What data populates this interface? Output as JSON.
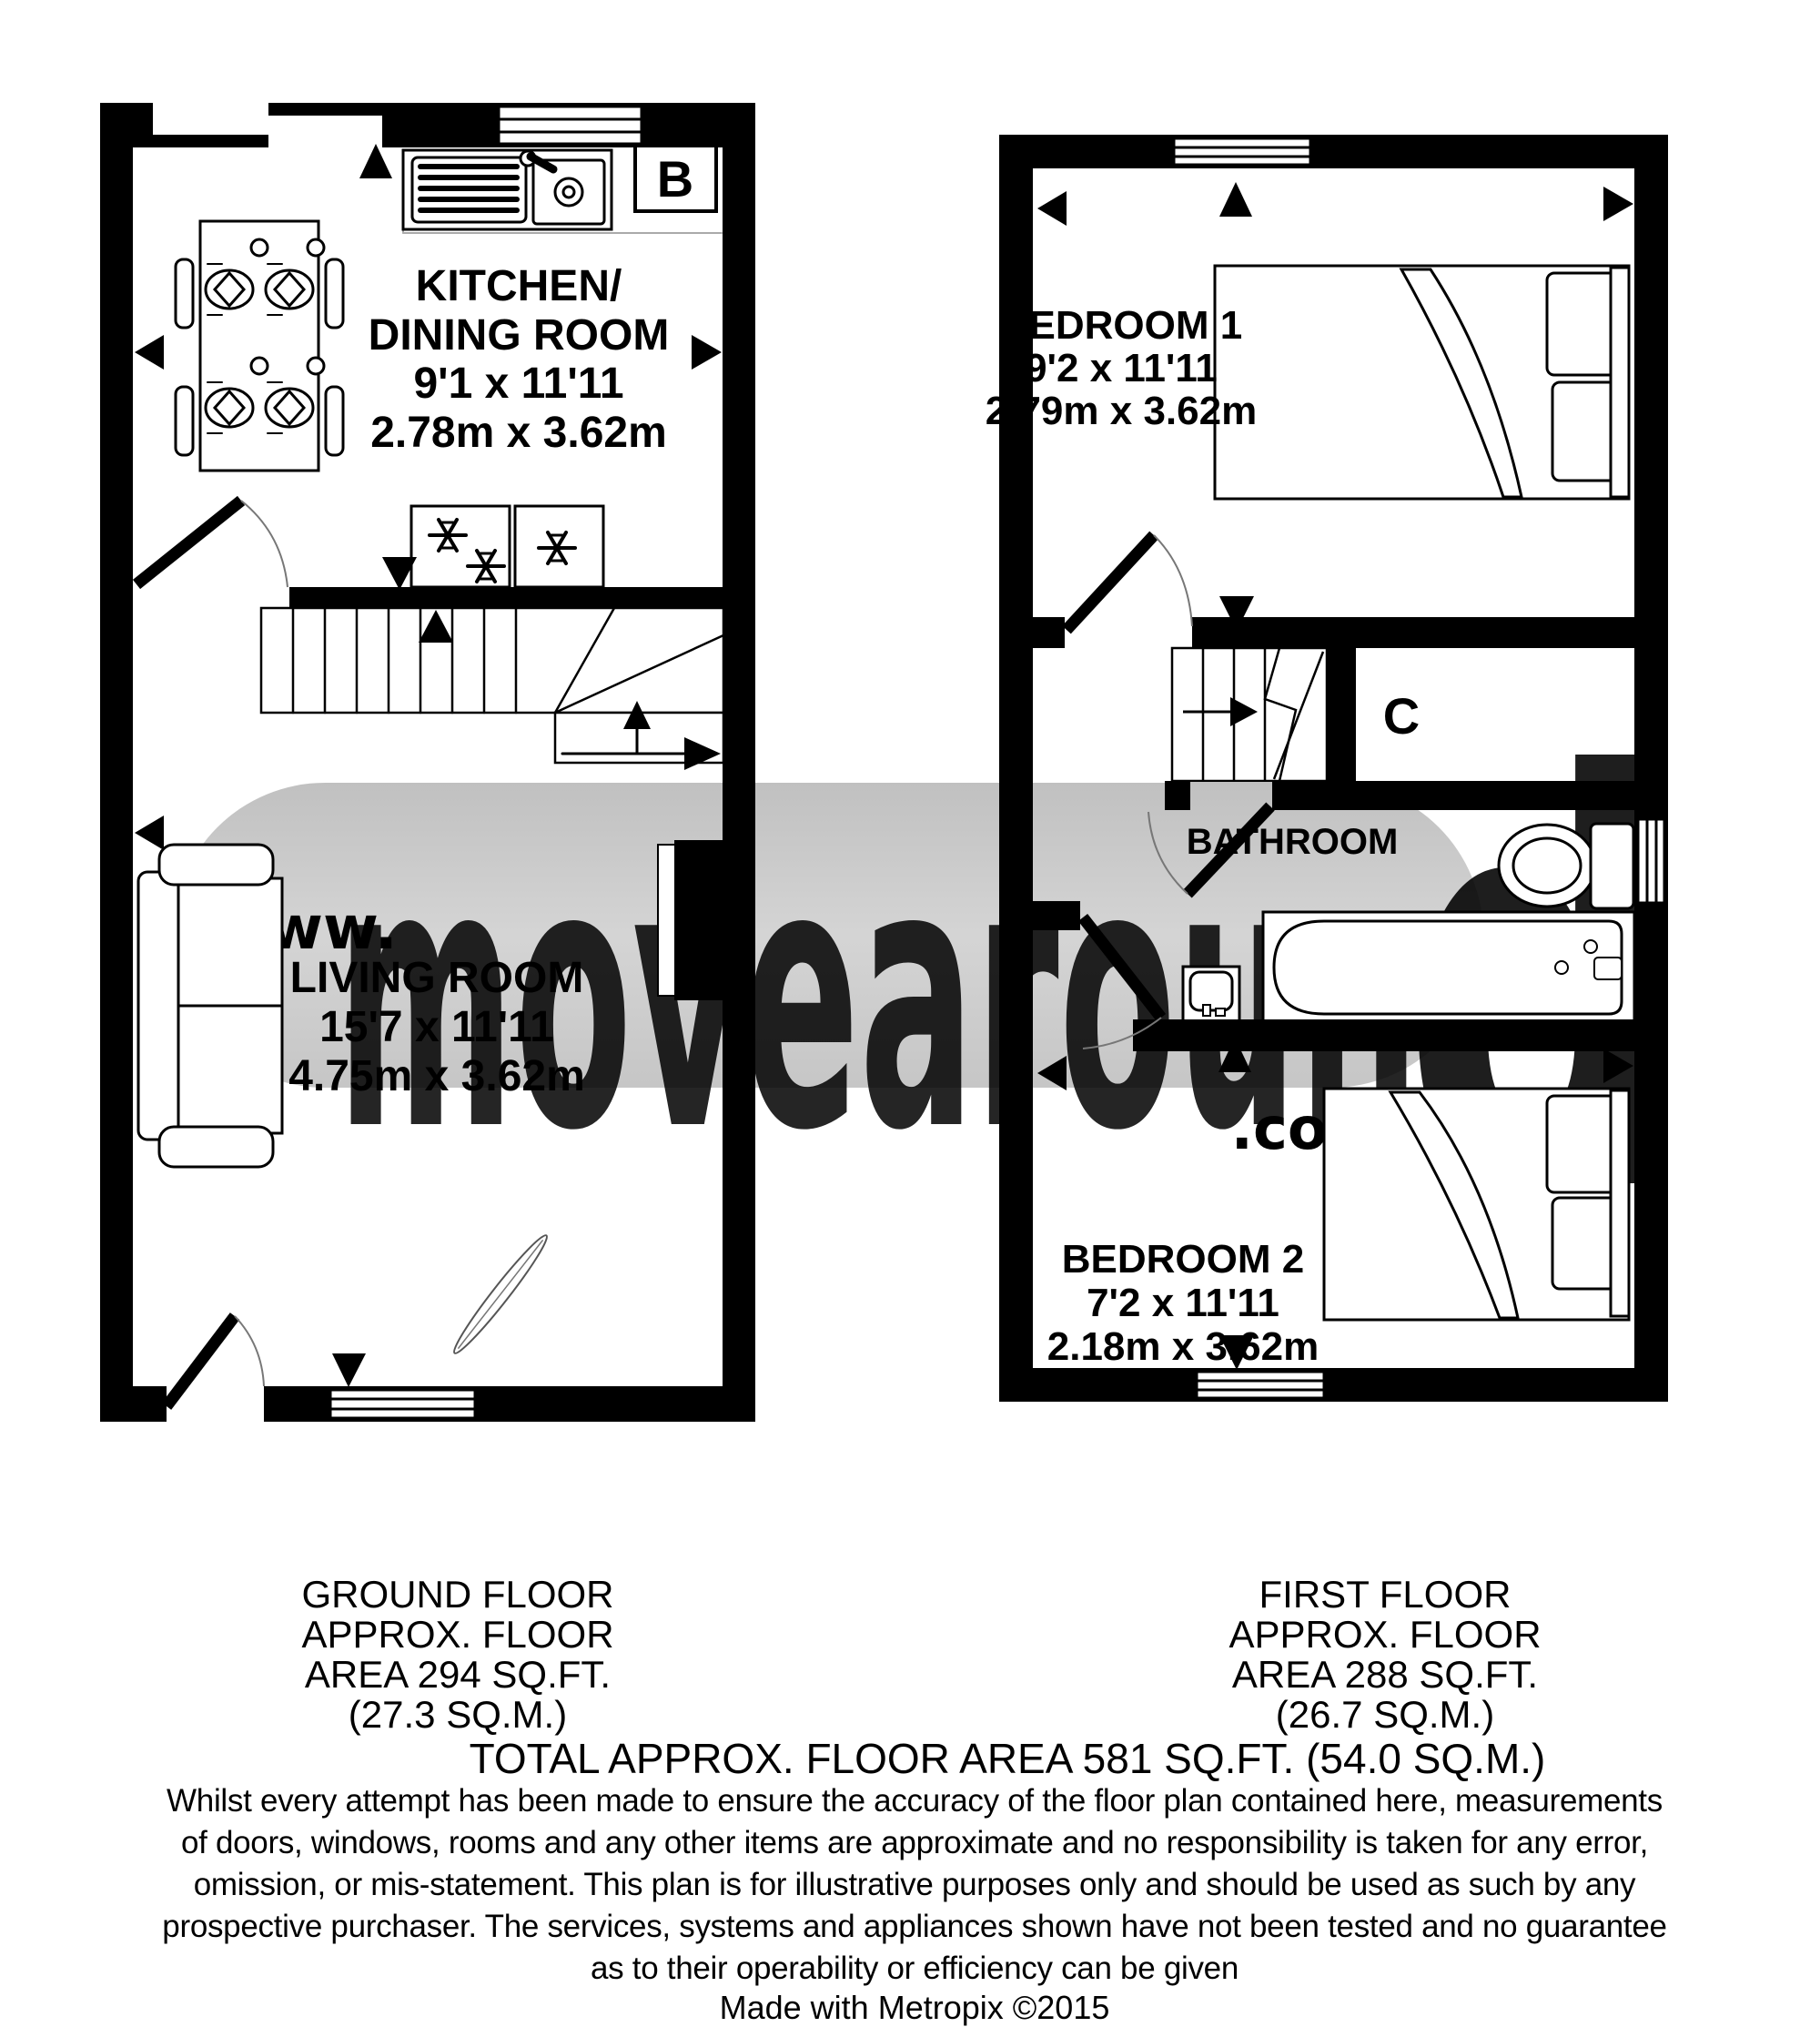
{
  "watermark": {
    "www": "www.",
    "brand_main": "movearoun",
    "brand_last": "d",
    "couk": ".co.uk"
  },
  "ground_floor": {
    "kitchen": {
      "name_line1": "KITCHEN/",
      "name_line2": "DINING ROOM",
      "dims_imperial": "9'1 x 11'11",
      "dims_metric": "2.78m x 3.62m"
    },
    "living_room": {
      "name": "LIVING ROOM",
      "dims_imperial": "15'7 x 11'11",
      "dims_metric": "4.75m x 3.62m"
    },
    "boiler_label": "B"
  },
  "first_floor": {
    "bedroom1": {
      "name": "BEDROOM 1",
      "dims_imperial": "9'2 x 11'11",
      "dims_metric": "2.79m x 3.62m"
    },
    "bedroom2": {
      "name": "BEDROOM 2",
      "dims_imperial": "7'2 x 11'11",
      "dims_metric": "2.18m x 3.62m"
    },
    "bathroom_label": "BATHROOM",
    "cupboard_label": "C"
  },
  "footer": {
    "ground_label_lines": [
      "GROUND FLOOR",
      "APPROX. FLOOR",
      "AREA 294 SQ.FT.",
      "(27.3 SQ.M.)"
    ],
    "first_label_lines": [
      "FIRST FLOOR",
      "APPROX. FLOOR",
      "AREA 288 SQ.FT.",
      "(26.7 SQ.M.)"
    ],
    "total": "TOTAL APPROX. FLOOR AREA 581 SQ.FT. (54.0 SQ.M.)",
    "disclaimer_lines": [
      "Whilst every attempt has been made to ensure the accuracy of the floor plan contained here, measurements",
      "of doors, windows, rooms and any other items are approximate and no responsibility is taken for any error,",
      "omission, or mis-statement. This plan is for illustrative purposes only and should be used as such by any",
      "prospective purchaser. The services, systems and appliances shown have not been tested and no guarantee",
      "as to their operability or efficiency can be given"
    ],
    "credit": "Made with Metropix ©2015"
  },
  "icons": {
    "snowflake-icon": "fridge/freezer marker",
    "sink-icon": "kitchen sink with drainer",
    "bed-icon": "bed with pillows and folded sheet",
    "sofa-icon": "two seat sofa",
    "dining-table-icon": "table with four place settings",
    "bath-icon": "bathtub",
    "toilet-icon": "toilet",
    "basin-icon": "wash basin",
    "stairs-icon": "staircase with direction arrow"
  },
  "colors": {
    "wall": "#000000",
    "watermark_gray": "#c9c9c9",
    "watermark_letters": "#ebebeb",
    "watermark_pink": "#f6aed3",
    "floor": "#ffffff"
  }
}
